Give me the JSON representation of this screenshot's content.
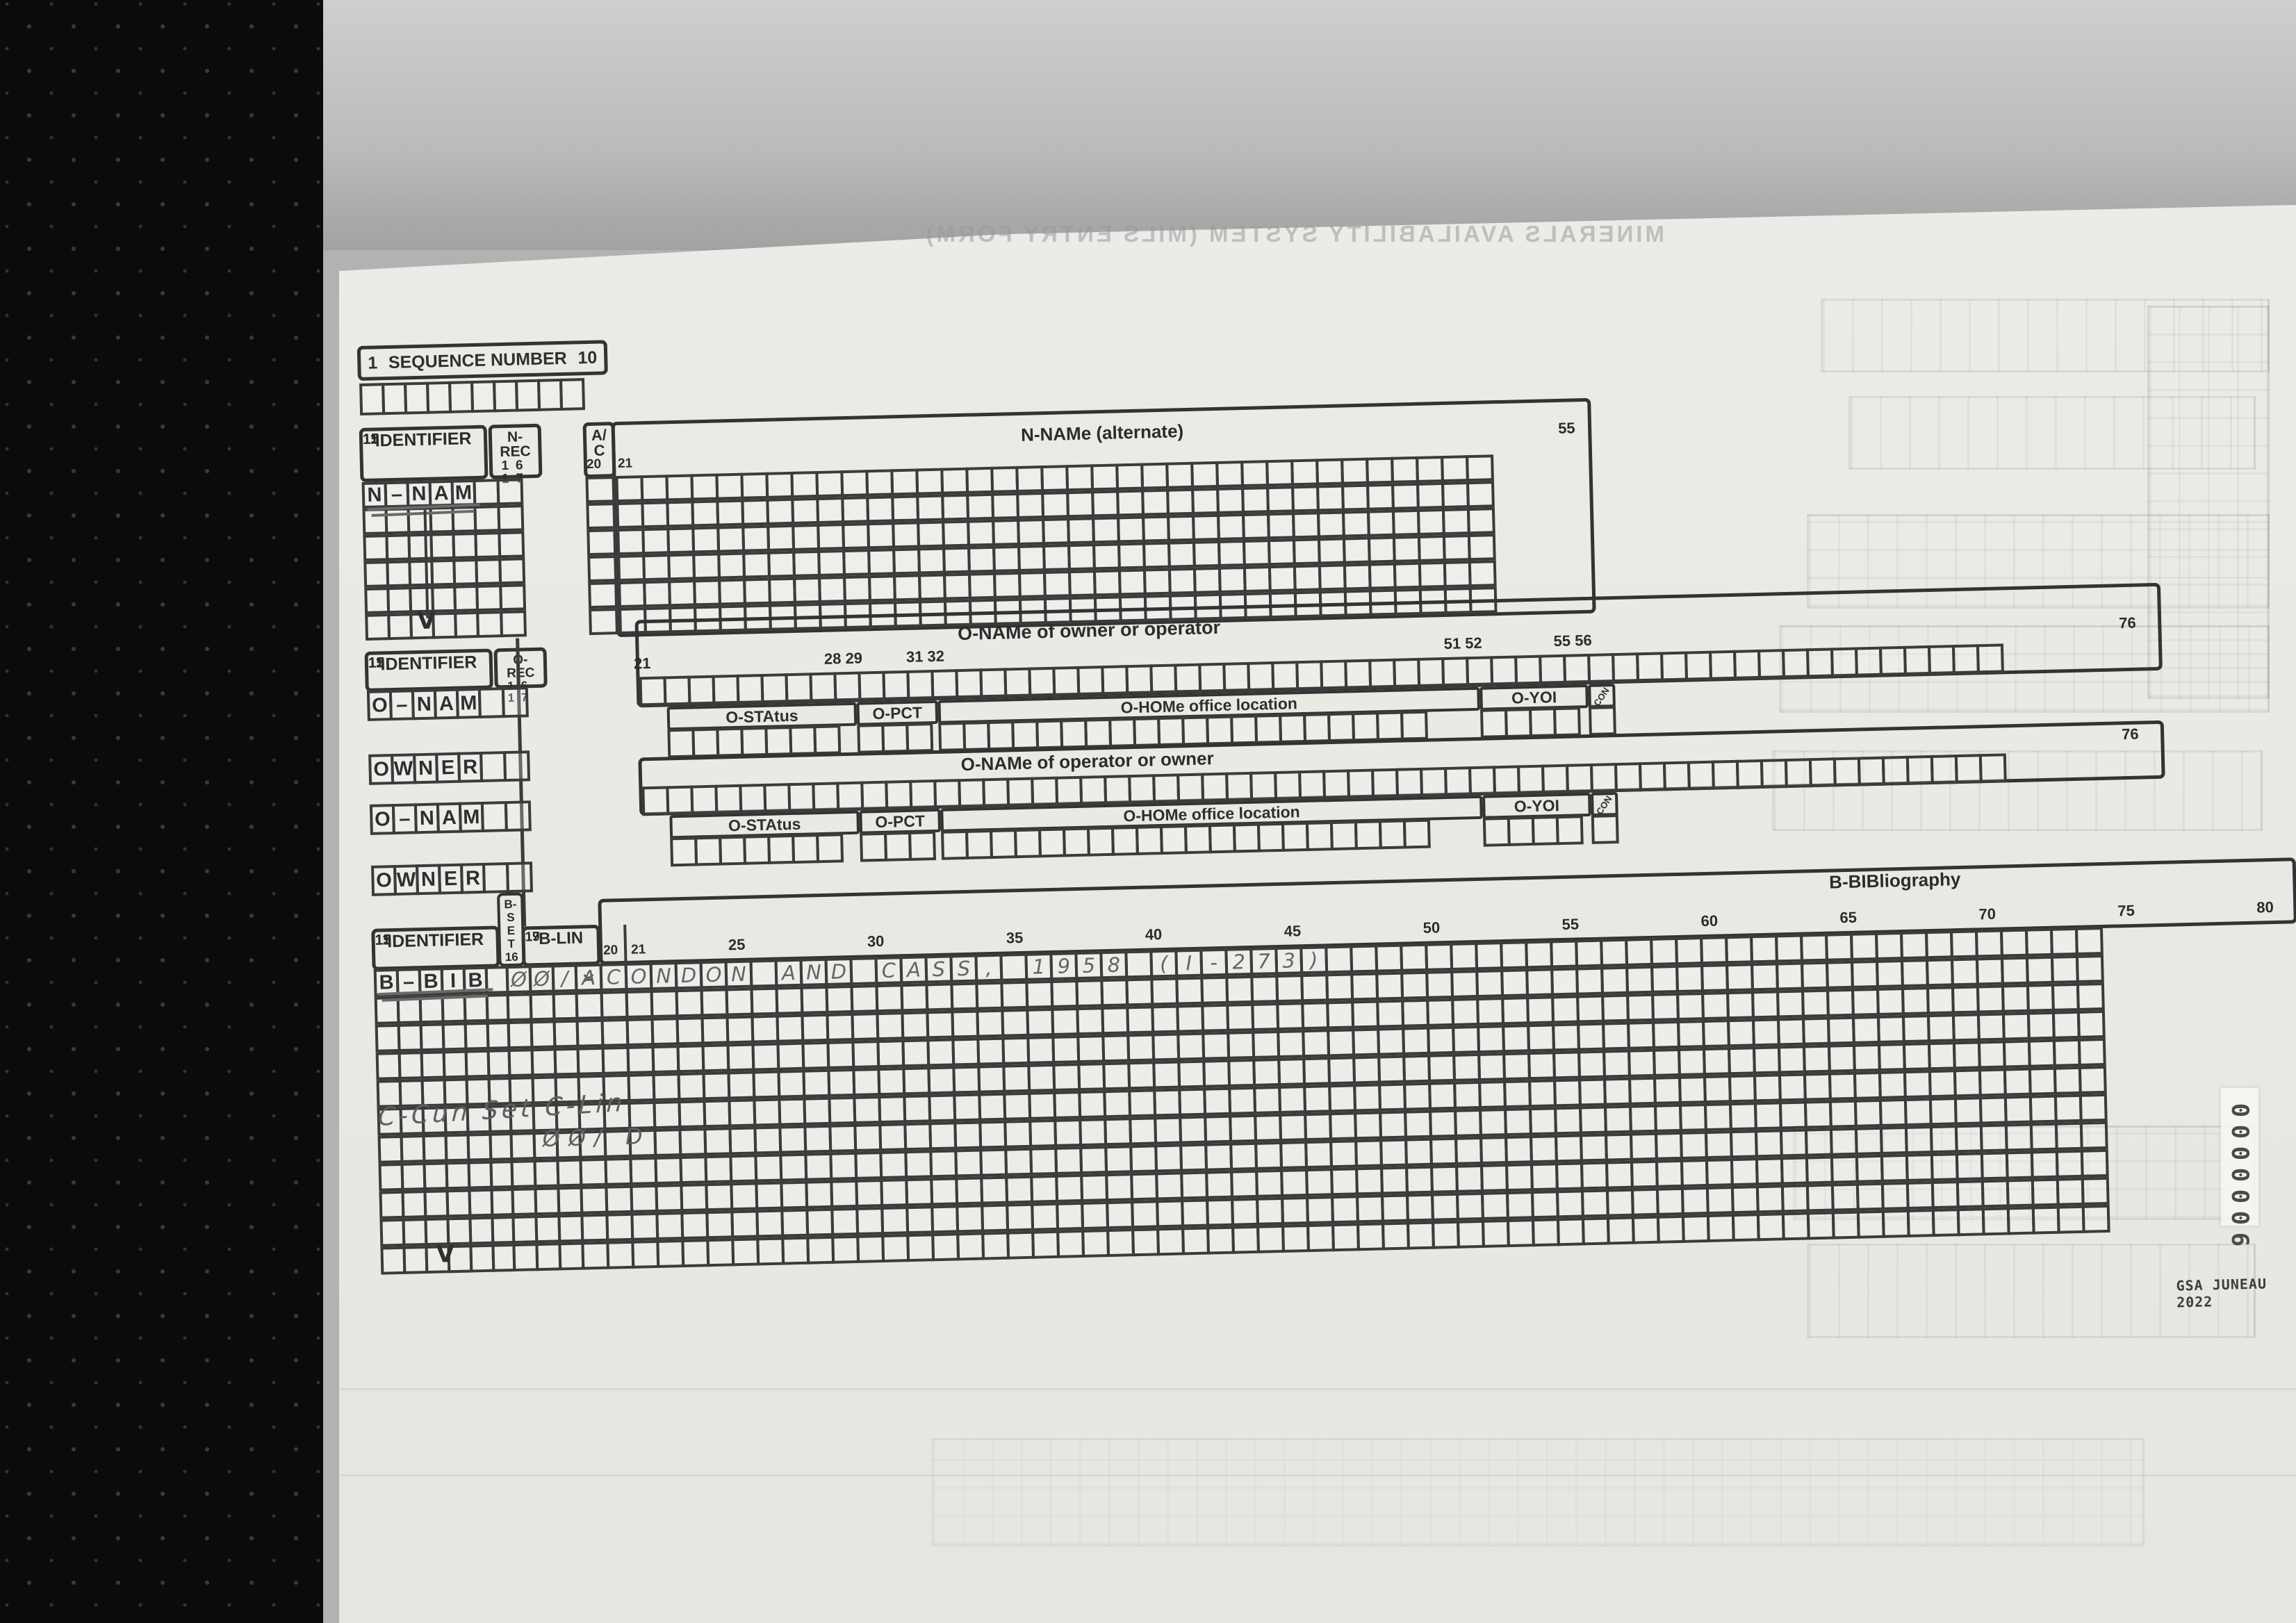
{
  "ghost_title": "MINERALS AVAILABILITY SYSTEM (MILS ENTRY FORM)",
  "sequence": {
    "left_num": "1",
    "label": "SEQUENCE NUMBER",
    "right_num": "10"
  },
  "identifier": {
    "label": "IDENTIFIER",
    "left_num": "11",
    "right_num": "15"
  },
  "n_section": {
    "rec_top": "N-",
    "rec_bottom": "REC",
    "rec_nums": "16 17",
    "row_letters": [
      "N",
      "–",
      "N",
      "A",
      "M"
    ],
    "ac_top": "A/",
    "ac_bottom": "C",
    "num20": "20",
    "num21": "21",
    "grid_header": "N-NAMe  (alternate)",
    "grid_end_num": "55"
  },
  "o_section1": {
    "rec_top": "O-",
    "rec_bottom": "REC",
    "rec_nums": "16 17",
    "header": "O-NAMe  of  owner  or  operator",
    "col_nums": [
      "21",
      "28 29",
      "31 32",
      "51 52",
      "55 56"
    ],
    "end_num": "76",
    "nam_letters": [
      "O",
      "–",
      "N",
      "A",
      "M"
    ],
    "owner_letters": [
      "O",
      "W",
      "N",
      "E",
      "R"
    ],
    "labels": {
      "sta": "O-STAtus",
      "pct": "O-PCT",
      "hom": "O-HOMe  office  location",
      "yoi": "O-YOI",
      "con": "CON"
    }
  },
  "o_section2": {
    "header": "O-NAMe  of  operator  or  owner",
    "end_num": "76",
    "nam_letters": [
      "O",
      "–",
      "N",
      "A",
      "M"
    ],
    "owner_letters": [
      "O",
      "W",
      "N",
      "E",
      "R"
    ],
    "labels": {
      "sta": "O-STAtus",
      "pct": "O-PCT",
      "hom": "O-HOMe  office  location",
      "yoi": "O-YOI",
      "con": "CON"
    }
  },
  "b_section": {
    "bset_label": "B-SET",
    "bset_num": "16",
    "blin_label": "B-LIN",
    "num17": "17",
    "num19": "19",
    "num20": "20",
    "num21": "21",
    "header": "B-BIBliography",
    "col_nums": [
      "25",
      "30",
      "35",
      "40",
      "45",
      "50",
      "55",
      "60",
      "65",
      "70",
      "75",
      "80"
    ],
    "row_letters": [
      "B",
      "–",
      "B",
      "I",
      "B"
    ],
    "hand_blin": "ØØ/",
    "hand_crossed": "A",
    "hand_bib": "CONDON AND CASS, 1958 (I-273)",
    "hand_note": "C-Cun Set C-Lin",
    "hand_note2": "ØØ/ D"
  },
  "stamp_digits": [
    "0",
    "0",
    "0",
    "0",
    "0",
    "0",
    "6"
  ],
  "footer_stamp": "GSA JUNEAU 2022",
  "colors": {
    "ink": "#2f2f2f",
    "pencil": "#646464",
    "paper": "#e9e8e3",
    "black_margin": "#0b0b0b"
  }
}
